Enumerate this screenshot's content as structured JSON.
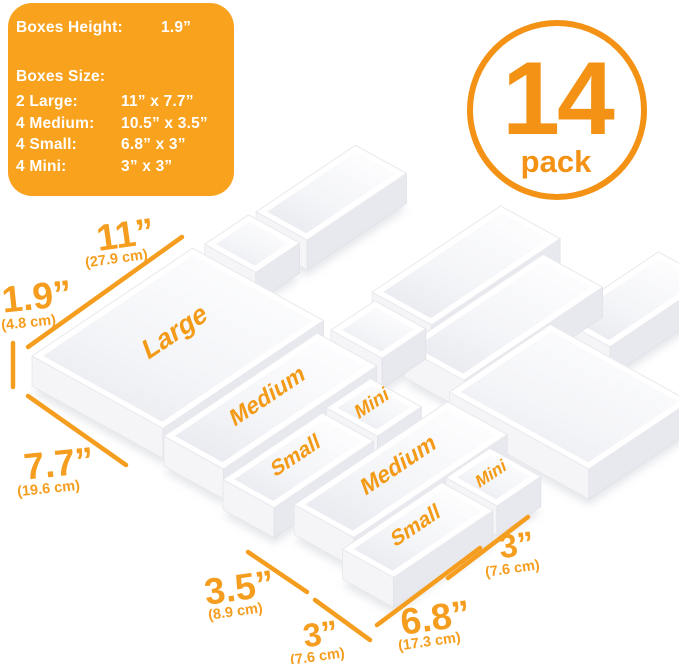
{
  "colors": {
    "orange": "#F59D1E",
    "panel_orange": "#F9A21E",
    "badge_orange": "#F39214",
    "box_white": "#FFFFFF",
    "wall_shade": "#E8E9EF"
  },
  "info_panel": {
    "height_label": "Boxes Height:",
    "height_value": "1.9”",
    "size_label": "Boxes Size:",
    "rows": [
      {
        "label": "2 Large:",
        "value": "11” x 7.7”"
      },
      {
        "label": "4 Medium:",
        "value": "10.5” x 3.5”"
      },
      {
        "label": "4 Small:",
        "value": "6.8” x 3”"
      },
      {
        "label": "4 Mini:",
        "value": "3” x 3”"
      }
    ]
  },
  "badge": {
    "number": "14",
    "label": "pack"
  },
  "scene": {
    "box_labels": {
      "large": "Large",
      "medium": "Medium",
      "small": "Small",
      "mini": "Mini"
    }
  },
  "dimensions": [
    {
      "name": "large-width",
      "value": "11”",
      "metric": "(27.9 cm)"
    },
    {
      "name": "box-height",
      "value": "1.9”",
      "metric": "(4.8 cm)"
    },
    {
      "name": "large-depth",
      "value": "7.7”",
      "metric": "(19.6 cm)"
    },
    {
      "name": "medium-width",
      "value": "3.5”",
      "metric": "(8.9 cm)"
    },
    {
      "name": "small-width",
      "value": "3”",
      "metric": "(7.6 cm)"
    },
    {
      "name": "small-length",
      "value": "6.8”",
      "metric": "(17.3 cm)"
    },
    {
      "name": "mini-width",
      "value": "3”",
      "metric": "(7.6 cm)"
    }
  ]
}
